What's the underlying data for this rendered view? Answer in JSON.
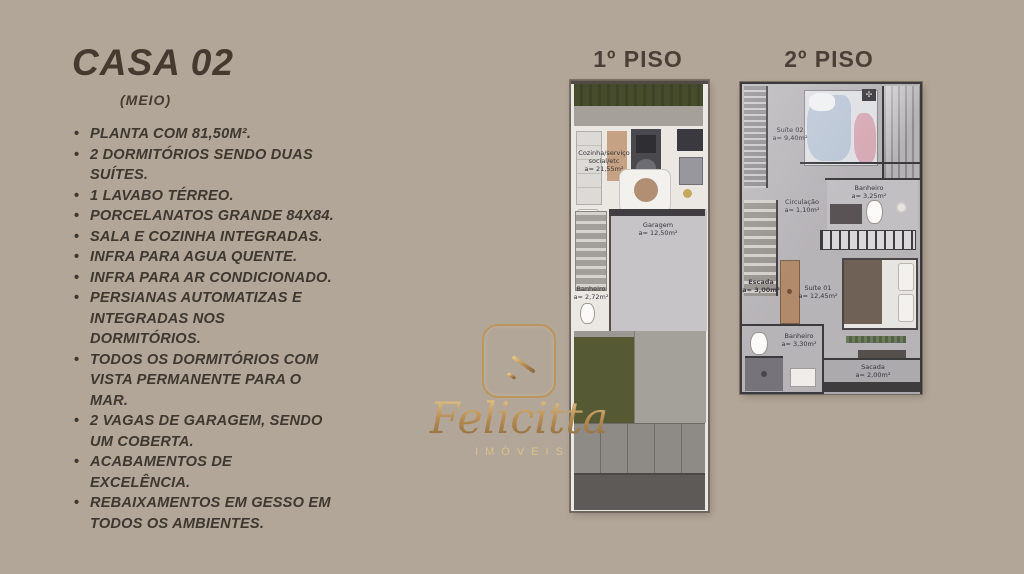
{
  "listing": {
    "title": "CASA 02",
    "subtitle": "(MEIO)",
    "features": [
      "PLANTA COM 81,50M².",
      "2 DORMITÓRIOS SENDO DUAS SUÍTES.",
      "1 LAVABO TÉRREO.",
      "PORCELANATOS GRANDE 84X84.",
      "SALA E COZINHA INTEGRADAS.",
      "INFRA PARA AGUA QUENTE.",
      "INFRA PARA AR CONDICIONADO.",
      "PERSIANAS AUTOMATIZAS E INTEGRADAS NOS DORMITÓRIOS.",
      "TODOS OS DORMITÓRIOS COM VISTA PERMANENTE PARA O MAR.",
      "2 VAGAS DE GARAGEM, SENDO UM COBERTA.",
      "ACABAMENTOS DE EXCELÊNCIA.",
      "REBAIXAMENTOS EM GESSO EM TODOS OS AMBIENTES."
    ]
  },
  "floor1": {
    "heading": "1º PISO",
    "rooms": {
      "living": {
        "name": "Cozinha/serviço social/etc",
        "area": "a= 21,55m²"
      },
      "garage": {
        "name": "Garagem",
        "area": "a= 12,50m²"
      },
      "bath": {
        "name": "Banheiro",
        "area": "a= 2,72m²"
      }
    }
  },
  "floor2": {
    "heading": "2º PISO",
    "rooms": {
      "suite2": {
        "name": "Suíte 02",
        "area": "a= 9,40m²"
      },
      "bath_upper": {
        "name": "Banheiro",
        "area": "a= 3,25m²"
      },
      "circulation": {
        "name": "Circulação",
        "area": "a= 1,10m²"
      },
      "stairs": {
        "name": "Escada",
        "area": "a= 3,00m²"
      },
      "suite1": {
        "name": "Suíte 01",
        "area": "a= 12,45m²"
      },
      "bath_lower": {
        "name": "Banheiro",
        "area": "a= 3,30m²"
      },
      "balcony": {
        "name": "Sacada",
        "area": "a= 2,00m²"
      }
    }
  },
  "logo": {
    "wordmark": "Felicitta",
    "tagline": "IMÓVEIS",
    "gold": "#b98f55"
  },
  "colors": {
    "background": "#b2a698",
    "text": "#3e3831"
  }
}
